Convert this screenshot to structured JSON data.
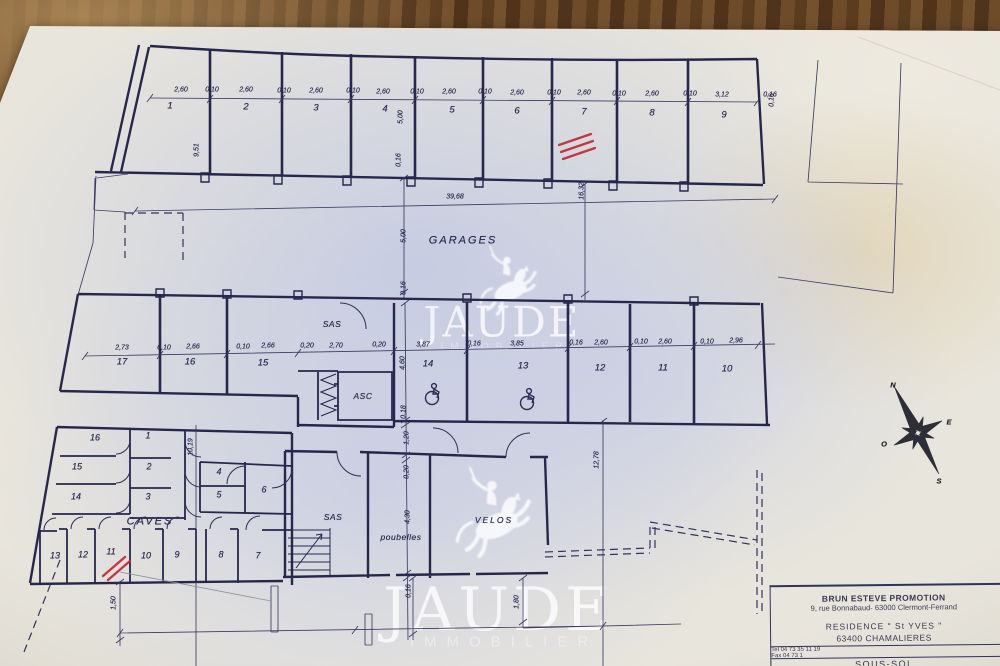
{
  "sheet": {
    "drawing_type": "floor-plan",
    "level_label": "SOUS-SOL"
  },
  "rooms": {
    "garages": "GARAGES",
    "caves": "CAVES",
    "sas_upper": "SAS",
    "sas_lower": "SAS",
    "asc": "ASC",
    "poubelles": "poubelles",
    "velos": "VELOS"
  },
  "garages": {
    "top": [
      "1",
      "2",
      "3",
      "4",
      "5",
      "6",
      "7",
      "8",
      "9"
    ],
    "mid": [
      "17",
      "16",
      "15",
      "14",
      "13",
      "12",
      "11",
      "10"
    ]
  },
  "caves": {
    "left": [
      "16",
      "15",
      "14"
    ],
    "mid": [
      "1",
      "2",
      "3"
    ],
    "right": [
      "4",
      "5",
      "6"
    ],
    "bottom": [
      "13",
      "12",
      "11",
      "10",
      "9",
      "8",
      "7"
    ]
  },
  "dims": {
    "total": "39,68",
    "top": [
      "2,60",
      "0,10",
      "2,60",
      "0,10",
      "2,60",
      "0,10",
      "2,60",
      "0,10",
      "2,60",
      "0,10",
      "2,60",
      "0,10",
      "2,60",
      "0,10",
      "2,60",
      "0,10",
      "3,12",
      "0,16"
    ],
    "mid": [
      "2,73",
      "0,10",
      "2,66",
      "0,10",
      "2,66",
      "0,20",
      "2,70",
      "0,20",
      "3,87",
      "0,16",
      "3,85",
      "0,16",
      "2,60",
      "0,10",
      "2,60",
      "0,10",
      "2,96"
    ],
    "v": [
      "9,51",
      "5,00",
      "0,16",
      "5,00",
      "0,16",
      "16,32",
      "4,60",
      "0,18",
      "1,20",
      "0,20",
      "4,30",
      "0,16",
      "10,19",
      "12,78",
      "1,50",
      "1,80",
      "0,16"
    ]
  },
  "compass": {
    "n": "N",
    "e": "E",
    "s": "S",
    "o": "O"
  },
  "watermark": {
    "brand": "JAUDE",
    "subtitle": "IMMOBILIER"
  },
  "title_block": {
    "company": "BRUN ESTEVE  PROMOTION",
    "address": "9, rue Bonnabaud- 63000 Clermont-Ferrand",
    "residence": "RESIDENCE \" St YVES \"",
    "city": "63400 CHAMALIERES",
    "tel": "Tel 04 73 35 11 19",
    "fax": "Fax 04 73 1",
    "sheet_title": "SOUS-SOL"
  },
  "colors": {
    "ink": "#2d2d55",
    "red_mark": "#bf2630",
    "paper_wash": "#c5cbe2",
    "wood": "#5d4024"
  }
}
